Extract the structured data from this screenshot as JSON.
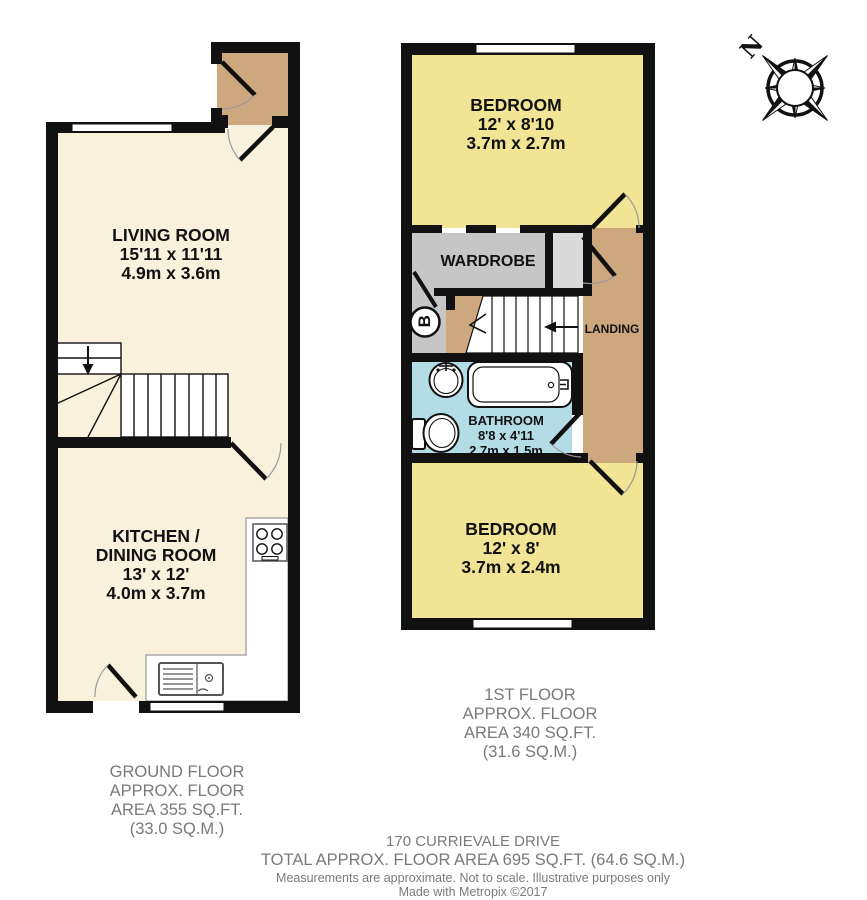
{
  "compass": {
    "north_label": "N"
  },
  "ground_floor": {
    "living_room": {
      "name": "LIVING ROOM",
      "imperial": "15'11 x 11'11",
      "metric": "4.9m x 3.6m"
    },
    "kitchen": {
      "line1": "KITCHEN /",
      "line2": "DINING ROOM",
      "imperial": "13' x 12'",
      "metric": "4.0m x 3.7m"
    },
    "area_label": [
      "GROUND FLOOR",
      "APPROX. FLOOR",
      "AREA 355 SQ.FT.",
      "(33.0 SQ.M.)"
    ]
  },
  "first_floor": {
    "bedroom_front": {
      "name": "BEDROOM",
      "imperial": "12' x 8'10",
      "metric": "3.7m x 2.7m"
    },
    "bedroom_back": {
      "name": "BEDROOM",
      "imperial": "12' x 8'",
      "metric": "3.7m x 2.4m"
    },
    "bathroom": {
      "name": "BATHROOM",
      "imperial": "8'8 x 4'11",
      "metric": "2.7m x 1.5m"
    },
    "wardrobe_label": "WARDROBE",
    "landing_label": "LANDING",
    "boiler_label": "B",
    "area_label": [
      "1ST FLOOR",
      "APPROX. FLOOR",
      "AREA 340 SQ.FT.",
      "(31.6 SQ.M.)"
    ]
  },
  "footer": {
    "address": "170 CURRIEVALE DRIVE",
    "total": "TOTAL APPROX. FLOOR AREA 695 SQ.FT. (64.6 SQ.M.)",
    "disclaimer": "Measurements are approximate.  Not to scale.  Illustrative purposes only",
    "credit": "Made with Metropix ©2017"
  },
  "colors": {
    "wall": "#111111",
    "floor_cream": "#faf1dc",
    "floor_yellow": "#f2e495",
    "floor_tan": "#cda87e",
    "floor_blue": "#b3dce6",
    "wardrobe_gray": "#c6c6c6",
    "cupboard_gray": "#dadada",
    "label_gray": "#7a7a7a"
  }
}
